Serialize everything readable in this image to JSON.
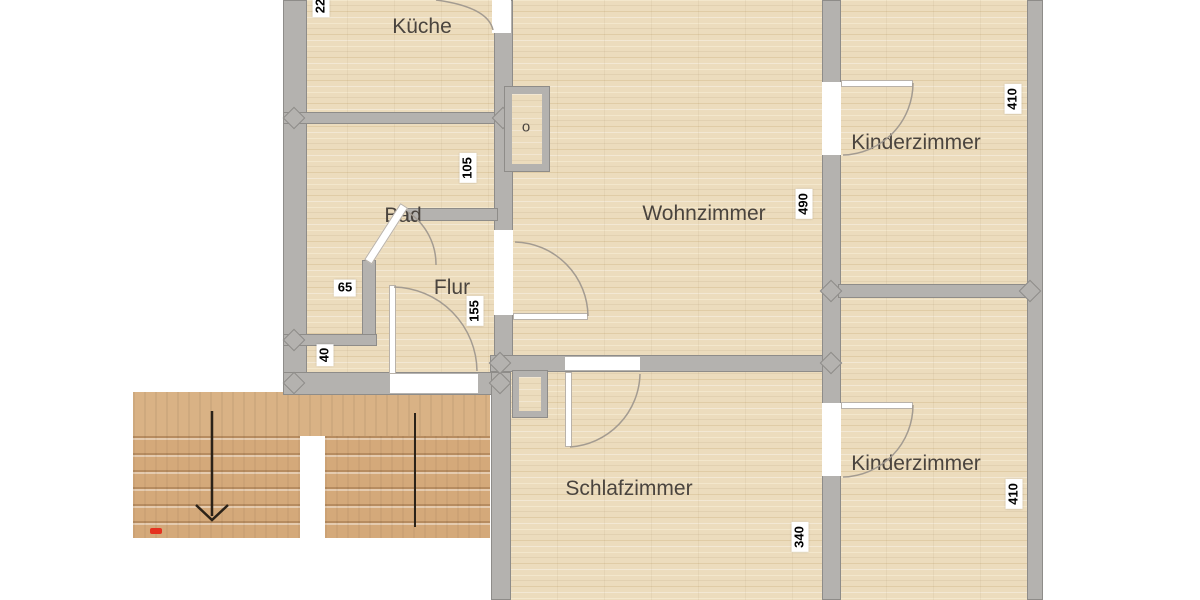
{
  "rooms": {
    "kueche": {
      "label": "Küche"
    },
    "bad": {
      "label": "Bad"
    },
    "flur": {
      "label": "Flur"
    },
    "wohnzimmer": {
      "label": "Wohnzimmer"
    },
    "kinderzimmer_top": {
      "label": "Kinderzimmer"
    },
    "kinderzimmer_bottom": {
      "label": "Kinderzimmer"
    },
    "schlafzimmer": {
      "label": "Schlafzimmer"
    },
    "shaft": {
      "label": "o"
    }
  },
  "dimensions": {
    "d22": {
      "value": "22"
    },
    "d105": {
      "value": "105"
    },
    "d65": {
      "value": "65"
    },
    "d155": {
      "value": "155"
    },
    "d40": {
      "value": "40"
    },
    "d490": {
      "value": "490"
    },
    "d410_top": {
      "value": "410"
    },
    "d340": {
      "value": "340"
    },
    "d410_bottom": {
      "value": "410"
    }
  },
  "colors": {
    "wall": "#b4b2af",
    "wall_border": "#8e8c89",
    "floor": "#ecdcbd",
    "floor_plank_light": "#f3e7cc",
    "floor_plank_dark": "#e0cca6",
    "stairs": "#d4a97a",
    "stairs_step_dark": "#b78c60",
    "stairs_landing": "#d9b285",
    "door_white": "#ffffff",
    "arc": "#a39b91",
    "stair_arrow": "#2b2218",
    "red_marker": "#e5311f",
    "label_text": "#4a443e"
  }
}
